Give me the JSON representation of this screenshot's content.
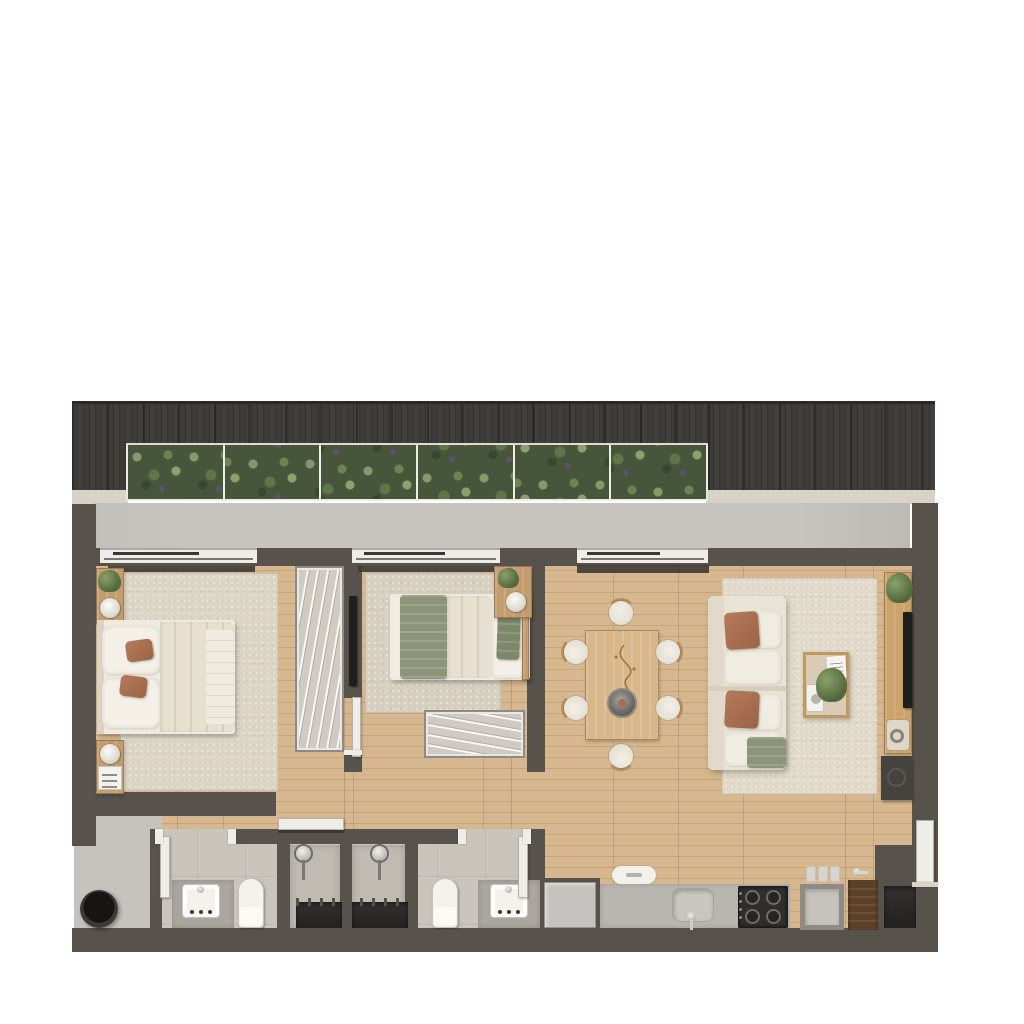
{
  "title": "apartment-floor-plan-top-view",
  "palette": {
    "page": "#ffffff",
    "wall": "#57534c",
    "woodband": "#3b3a37",
    "ledge": "#d9d3c7",
    "terrace": "#c8c5c0",
    "sill": "#efede7",
    "rail": "#3a3834",
    "wood": "#d2b28a",
    "tile": "#c9c4bc",
    "showerfloor": "#bfbab2",
    "entry": "#c6c3be",
    "rug1": "#dcd4c4",
    "rug2": "#d7cfbf",
    "rug3": "#e1daca",
    "bedwhite": "#efeae0",
    "pillowwhite": "#f4f0e7",
    "duvet": "#e7e0d1",
    "terracotta": "#a96f50",
    "sage": "#8c9579",
    "furnwood": "#c49d6f",
    "tablewood": "#d8b88a",
    "chairwood": "#b98d5c",
    "sofabase": "#e9e3d5",
    "cushion": "#f1ece1",
    "consolewood": "#cba36b",
    "counter": "#b9b6b1",
    "stove": "#2f2e2c",
    "fridge": "#c4c2be",
    "doorwhite": "#efede8",
    "potblack": "#161514",
    "planterframe": "#eceae3"
  },
  "balcony": {
    "planter_segments": 6
  },
  "windows": [
    {
      "x": 100,
      "w": 157
    },
    {
      "x": 352,
      "w": 148
    },
    {
      "x": 577,
      "w": 131
    }
  ],
  "dining": {
    "chairs": [
      {
        "cx": 621,
        "cy": 613,
        "rot": 0
      },
      {
        "cx": 621,
        "cy": 756,
        "rot": 180
      },
      {
        "cx": 576,
        "cy": 652,
        "rot": -90
      },
      {
        "cx": 576,
        "cy": 708,
        "rot": -90
      },
      {
        "cx": 668,
        "cy": 652,
        "rot": 90
      },
      {
        "cx": 668,
        "cy": 708,
        "rot": 90
      }
    ]
  },
  "rooms": [
    {
      "name": "balcony",
      "features": [
        "pergola-roof",
        "planter-hedge",
        "terrace-floor",
        "sliding-windows"
      ]
    },
    {
      "name": "bedroom-1",
      "furniture": [
        "double-bed",
        "area-rug",
        "nightstand-with-plant-and-lamp",
        "nightstand-with-lamp-and-book",
        "terracotta-pillows",
        "wardrobe-with-hangers",
        "wall-tv"
      ]
    },
    {
      "name": "bedroom-2",
      "furniture": [
        "single-bed",
        "sage-throw",
        "sage-pillow",
        "area-rug",
        "nightstand-with-plant-and-lamp",
        "wardrobe-with-hangers",
        "door"
      ]
    },
    {
      "name": "living-dining",
      "furniture": [
        "dining-table",
        "six-chairs",
        "decor-branch",
        "centerpiece-bowl",
        "sofa",
        "terracotta-cushions",
        "sage-throw",
        "coffee-table-with-plant",
        "tv-console",
        "wall-tv",
        "media-cabinet",
        "area-rug"
      ]
    },
    {
      "name": "bathroom-1",
      "furniture": [
        "vanity-sink",
        "toilet",
        "shower-with-round-head",
        "door"
      ]
    },
    {
      "name": "bathroom-2",
      "furniture": [
        "vanity-sink",
        "toilet",
        "shower-with-round-head",
        "door"
      ]
    },
    {
      "name": "kitchen",
      "furniture": [
        "refrigerator",
        "counter",
        "kitchen-sink",
        "cooktop-4-burners",
        "laundry-tub",
        "glass-jars",
        "wood-cabinet-with-faucet",
        "stool",
        "wall-niche"
      ]
    },
    {
      "name": "entry-hall",
      "furniture": [
        "black-floor-pot"
      ]
    }
  ]
}
